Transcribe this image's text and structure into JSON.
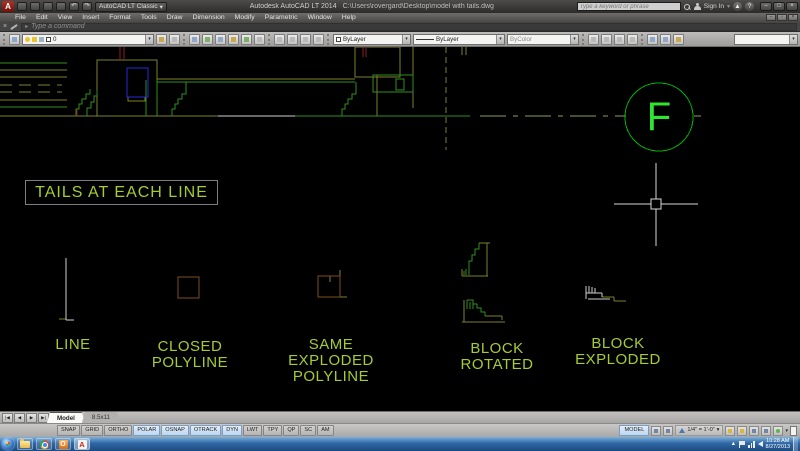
{
  "window": {
    "app_title": "Autodesk AutoCAD LT 2014",
    "doc_path": "C:\\Users\\rovergard\\Desktop\\model with tails.dwg",
    "workspace": "AutoCAD LT Classic",
    "search_placeholder": "Type a keyword or phrase",
    "sign_in": "Sign In"
  },
  "icons": {
    "undo": "↶",
    "redo": "↷",
    "dropdown": "▾",
    "close": "×",
    "minimize": "–",
    "maximize": "□",
    "restore": "▫",
    "help": "?",
    "cmd_chevron": "▸",
    "tray_arrow": "▲"
  },
  "menus": [
    "File",
    "Edit",
    "View",
    "Insert",
    "Format",
    "Tools",
    "Draw",
    "Dimension",
    "Modify",
    "Parametric",
    "Window",
    "Help"
  ],
  "command_line": {
    "prompt": "Type a command"
  },
  "toolbars": {
    "layer_value": "0",
    "color_value": "ByLayer",
    "linetype_value": "ByLayer",
    "plotstyle_value": "ByColor"
  },
  "canvas": {
    "tails_note": "TAILS AT EACH LINE",
    "circle_letter": "F",
    "labels": {
      "line": [
        "LINE"
      ],
      "closed_polyline": [
        "CLOSED",
        "POLYLINE"
      ],
      "same_exploded_polyline": [
        "SAME",
        "EXPLODED",
        "POLYLINE"
      ],
      "block_rotated": [
        "BLOCK",
        "ROTATED"
      ],
      "block_exploded": [
        "BLOCK",
        "EXPLODED"
      ]
    },
    "colors": {
      "label_green": "#a6cc35",
      "bright_green": "#2fe62f",
      "circle_green": "#00b303",
      "olive": "#7f7f2d",
      "blue": "#2828d8",
      "brown": "#7d4e1c"
    }
  },
  "tabs": {
    "nav": [
      "|◀",
      "◀",
      "▶",
      "▶|"
    ],
    "items": [
      {
        "label": "Model",
        "active": true
      },
      {
        "label": "8.5x11",
        "active": false
      }
    ]
  },
  "status": {
    "toggles": [
      {
        "label": "SNAP",
        "on": false
      },
      {
        "label": "GRID",
        "on": false
      },
      {
        "label": "ORTHO",
        "on": false
      },
      {
        "label": "POLAR",
        "on": true
      },
      {
        "label": "OSNAP",
        "on": true
      },
      {
        "label": "OTRACK",
        "on": true
      },
      {
        "label": "DYN",
        "on": true
      },
      {
        "label": "LWT",
        "on": false
      },
      {
        "label": "TPY",
        "on": false
      },
      {
        "label": "QP",
        "on": false
      },
      {
        "label": "SC",
        "on": false
      },
      {
        "label": "AM",
        "on": false
      }
    ],
    "model_label": "MODEL",
    "scale": "1/4\" = 1'-0\""
  },
  "taskbar": {
    "clock_time": "10:28 AM",
    "clock_date": "8/27/2013"
  }
}
